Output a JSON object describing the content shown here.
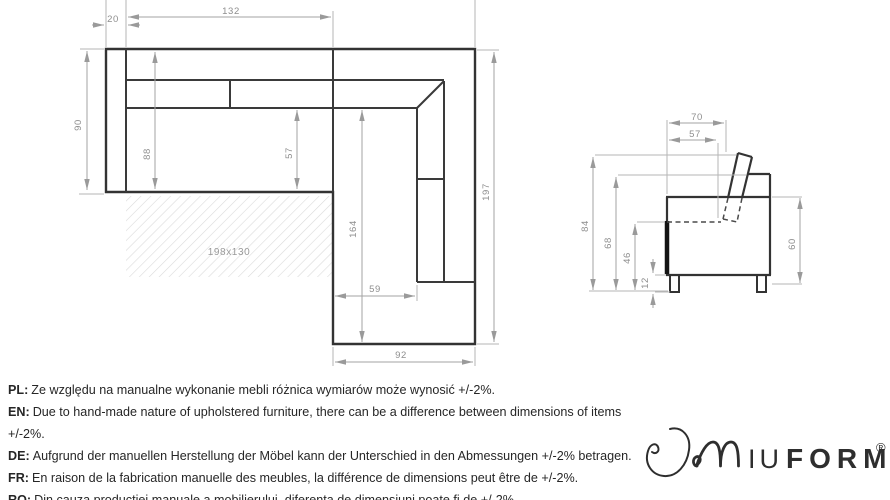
{
  "top_view": {
    "title": "corner-sofa-top-view",
    "dims": {
      "d132": "132",
      "d20": "20",
      "d90": "90",
      "d88": "88",
      "d57": "57",
      "d197": "197",
      "d164": "164",
      "d59": "59",
      "d92": "92",
      "mattress": "198x130"
    }
  },
  "side_view": {
    "title": "sofa-side-view",
    "dims": {
      "d70": "70",
      "d57": "57",
      "d84": "84",
      "d68": "68",
      "d46": "46",
      "d12": "12",
      "d60": "60"
    }
  },
  "notes": [
    {
      "label": "PL:",
      "text": "Ze względu na manualne wykonanie mebli różnica wymiarów może wynosić +/-2%."
    },
    {
      "label": "EN:",
      "text": "Due to hand-made nature of upholstered furniture, there can be a difference between dimensions of items +/-2%."
    },
    {
      "label": "DE:",
      "text": "Aufgrund der manuellen Herstellung der Möbel kann der Unterschied in den Abmessungen +/-2% betragen."
    },
    {
      "label": "FR:",
      "text": "En raison de la fabrication manuelle des meubles, la différence de dimensions peut être de +/-2%."
    },
    {
      "label": "RO:",
      "text": "Din cauza producției manuale a mobilierului, diferența de dimensiuni poate fi de +/-2%."
    }
  ],
  "logo": {
    "brand": "MIUFORM",
    "iu": "IU",
    "form": "FORM",
    "registered": "®"
  },
  "colors": {
    "outline": "#333333",
    "dimension": "#a3a3a3",
    "dim_text": "#8e8e8e",
    "hatch": "#dadada",
    "text": "#262626",
    "logo": "#2e2e2e"
  }
}
